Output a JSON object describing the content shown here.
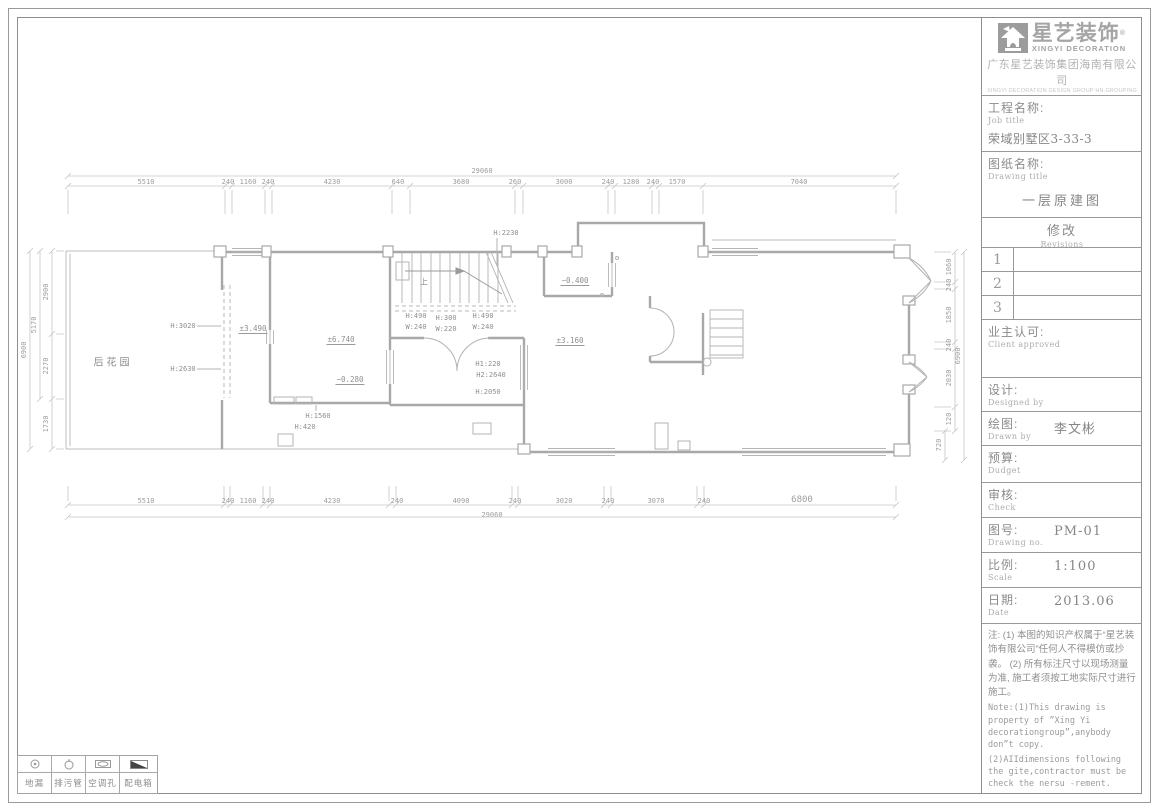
{
  "brand": {
    "logo_icon": "house-icon",
    "logo_text_cn": "星艺装饰",
    "logo_reg": "®",
    "logo_text_en": "XINGYI DECORATION",
    "company_cn": "广东星艺装饰集团海南有限公司",
    "company_en": "XINGYI DECORATION DESIGN GROUP HN.GROUPING"
  },
  "title_block": {
    "job_label_cn": "工程名称:",
    "job_label_en": "Job title",
    "job_value": "荣域别墅区3-33-3",
    "drawing_label_cn": "图纸名称:",
    "drawing_label_en": "Drawing title",
    "drawing_value": "一层原建图",
    "revisions_cn": "修改",
    "revisions_en": "Revisions",
    "revision_rows": [
      "1",
      "2",
      "3"
    ],
    "client_cn": "业主认可:",
    "client_en": "Client approved",
    "designed_cn": "设计:",
    "designed_en": "Designed by",
    "drawn_cn": "绘图:",
    "drawn_en": "Drawn by",
    "drawn_value": "李文彬",
    "budget_cn": "预算:",
    "budget_en": "Dudget",
    "check_cn": "审核:",
    "check_en": "Check",
    "no_cn": "图号:",
    "no_en": "Drawing no.",
    "no_value": "PM-01",
    "scale_cn": "比例:",
    "scale_en": "Scale",
    "scale_value": "1:100",
    "date_cn": "日期:",
    "date_en": "Date",
    "date_value": "2013.06",
    "note_cn": "注: (1) 本图的知识产权属于“星艺装饰有限公司”任何人不得模仿或抄袭。 (2) 所有标注尺寸以现场测量为准, 施工者须按工地实际尺寸进行施工。",
    "note_en1": "Note:(1)This drawing is property of ”Xing Yi decorationgroup”,anybody don”t copy.",
    "note_en2": "    (2)AIIdimensions following the gite,contractor must be check the nersu -rement."
  },
  "legend": {
    "items": [
      {
        "icon": "floor-drain-icon",
        "label": "地漏"
      },
      {
        "icon": "sewage-pipe-icon",
        "label": "排污管"
      },
      {
        "icon": "ac-hole-icon",
        "label": "空调孔"
      },
      {
        "icon": "distribution-box-icon",
        "label": "配电箱"
      }
    ]
  },
  "plan": {
    "rooms": [
      {
        "t": "后花园",
        "x": 113,
        "y": 361
      }
    ],
    "marks": [
      {
        "t": "上",
        "x": 424,
        "y": 282
      }
    ],
    "elevations": [
      {
        "t": "±3.490",
        "x": 253,
        "y": 329
      },
      {
        "t": "±6.740",
        "x": 341,
        "y": 340
      },
      {
        "t": "−0.280",
        "x": 350,
        "y": 380
      },
      {
        "t": "−0.400",
        "x": 575,
        "y": 281
      },
      {
        "t": "±3.160",
        "x": 570,
        "y": 341
      }
    ],
    "heights": [
      {
        "t": "H:3020",
        "x": 183,
        "y": 326
      },
      {
        "t": "H:2630",
        "x": 183,
        "y": 369
      },
      {
        "t": "H:2230",
        "x": 506,
        "y": 233
      },
      {
        "t": "H:490",
        "x": 416,
        "y": 316
      },
      {
        "t": "W:240",
        "x": 416,
        "y": 327
      },
      {
        "t": "H:300",
        "x": 446,
        "y": 318
      },
      {
        "t": "W:220",
        "x": 446,
        "y": 329
      },
      {
        "t": "H:490",
        "x": 483,
        "y": 316
      },
      {
        "t": "W:240",
        "x": 483,
        "y": 327
      },
      {
        "t": "H:1560",
        "x": 318,
        "y": 416
      },
      {
        "t": "H:420",
        "x": 305,
        "y": 427
      },
      {
        "t": "H1:220",
        "x": 488,
        "y": 364
      },
      {
        "t": "H2:2640",
        "x": 491,
        "y": 375
      },
      {
        "t": "H:2050",
        "x": 488,
        "y": 392
      }
    ],
    "dims": {
      "top": [
        {
          "t": "5510",
          "x": 146,
          "y": 182
        },
        {
          "t": "240",
          "x": 228,
          "y": 182
        },
        {
          "t": "1160",
          "x": 248,
          "y": 182
        },
        {
          "t": "240",
          "x": 268,
          "y": 182
        },
        {
          "t": "4230",
          "x": 332,
          "y": 182
        },
        {
          "t": "640",
          "x": 398,
          "y": 182
        },
        {
          "t": "3680",
          "x": 461,
          "y": 182
        },
        {
          "t": "260",
          "x": 515,
          "y": 182
        },
        {
          "t": "3000",
          "x": 564,
          "y": 182
        },
        {
          "t": "240",
          "x": 608,
          "y": 182
        },
        {
          "t": "1280",
          "x": 631,
          "y": 182
        },
        {
          "t": "240",
          "x": 653,
          "y": 182
        },
        {
          "t": "1570",
          "x": 677,
          "y": 182
        },
        {
          "t": "7040",
          "x": 799,
          "y": 182
        }
      ],
      "top_total": {
        "t": "29060",
        "x": 482,
        "y": 171
      },
      "bottom": [
        {
          "t": "5510",
          "x": 146,
          "y": 501
        },
        {
          "t": "240",
          "x": 228,
          "y": 501
        },
        {
          "t": "1160",
          "x": 248,
          "y": 501
        },
        {
          "t": "240",
          "x": 268,
          "y": 501
        },
        {
          "t": "4230",
          "x": 332,
          "y": 501
        },
        {
          "t": "240",
          "x": 397,
          "y": 501
        },
        {
          "t": "4090",
          "x": 461,
          "y": 501
        },
        {
          "t": "240",
          "x": 515,
          "y": 501
        },
        {
          "t": "3020",
          "x": 564,
          "y": 501
        },
        {
          "t": "240",
          "x": 608,
          "y": 501
        },
        {
          "t": "3070",
          "x": 656,
          "y": 501
        },
        {
          "t": "240",
          "x": 704,
          "y": 501
        },
        {
          "t": "6800",
          "x": 802,
          "y": 500,
          "big": true
        }
      ],
      "bottom_total": {
        "t": "29060",
        "x": 492,
        "y": 515
      },
      "left": [
        {
          "t": "2900",
          "x": 46,
          "y": 292
        },
        {
          "t": "2270",
          "x": 46,
          "y": 366
        },
        {
          "t": "1730",
          "x": 46,
          "y": 424
        },
        {
          "t": "5170",
          "x": 34,
          "y": 325
        },
        {
          "t": "6900",
          "x": 24,
          "y": 350
        }
      ],
      "right": [
        {
          "t": "1060",
          "x": 949,
          "y": 267
        },
        {
          "t": "240",
          "x": 949,
          "y": 285
        },
        {
          "t": "1850",
          "x": 949,
          "y": 315
        },
        {
          "t": "240",
          "x": 949,
          "y": 345
        },
        {
          "t": "2030",
          "x": 949,
          "y": 378
        },
        {
          "t": "120",
          "x": 949,
          "y": 419
        },
        {
          "t": "720",
          "x": 939,
          "y": 445
        },
        {
          "t": "6900",
          "x": 958,
          "y": 356
        }
      ],
      "tick_lines": [
        {
          "h": 1,
          "y": 186,
          "a": 68,
          "b": 896,
          "ticks": [
            68,
            225,
            232,
            265,
            272,
            392,
            410,
            515,
            523,
            608,
            615,
            652,
            659,
            703,
            896
          ],
          "ext": [
            190,
            214
          ]
        },
        {
          "h": 1,
          "y": 176,
          "a": 68,
          "b": 896,
          "ticks": [
            68,
            896
          ]
        },
        {
          "h": 1,
          "y": 505,
          "a": 68,
          "b": 896,
          "ticks": [
            68,
            224,
            230,
            263,
            270,
            389,
            396,
            512,
            518,
            604,
            611,
            697,
            704,
            896
          ],
          "ext": [
            486,
            501
          ]
        },
        {
          "h": 1,
          "y": 517,
          "a": 68,
          "b": 896,
          "ticks": [
            68,
            896
          ]
        },
        {
          "h": 0,
          "x": 52,
          "a": 251,
          "b": 449,
          "ticks": [
            251,
            334,
            399,
            449
          ],
          "ext": [
            56,
            64
          ]
        },
        {
          "h": 0,
          "x": 40,
          "a": 251,
          "b": 399,
          "ticks": [
            251,
            399
          ]
        },
        {
          "h": 0,
          "x": 30,
          "a": 251,
          "b": 449,
          "ticks": [
            251,
            449
          ]
        },
        {
          "h": 0,
          "x": 955,
          "a": 252,
          "b": 431,
          "ticks": [
            252,
            282,
            289,
            342,
            349,
            407,
            431
          ],
          "ext": [
            934,
            951
          ]
        },
        {
          "h": 0,
          "x": 945,
          "a": 431,
          "b": 460,
          "ticks": [
            431,
            460
          ]
        },
        {
          "h": 0,
          "x": 964,
          "a": 252,
          "b": 460,
          "ticks": [
            252,
            460
          ]
        }
      ]
    }
  }
}
